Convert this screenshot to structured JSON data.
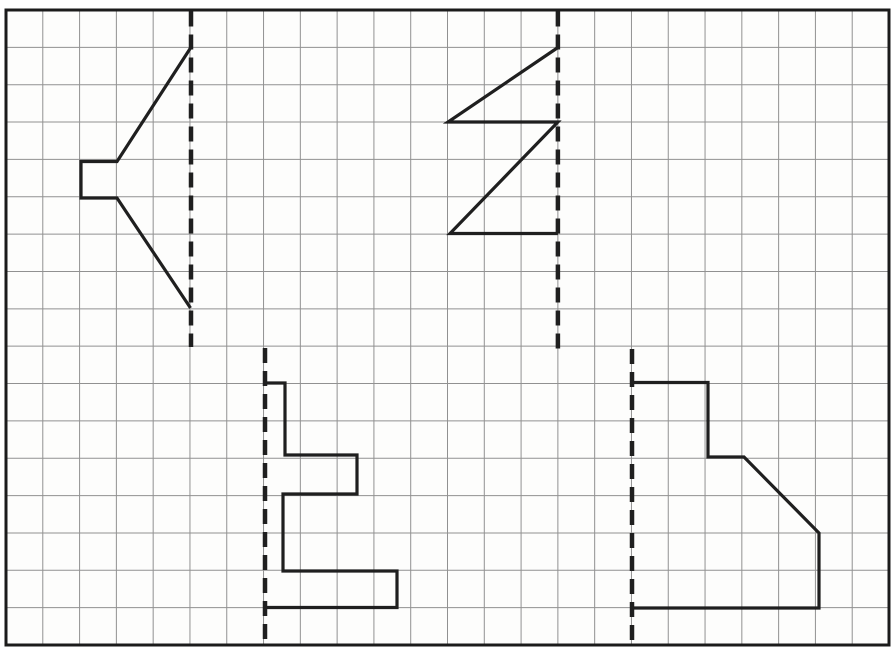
{
  "worksheet": {
    "kind": "reflection-symmetry-grid-exercise",
    "canvas": {
      "width": 895,
      "height": 656
    },
    "colors": {
      "paper": "#fdfdfc",
      "grid_line": "#919191",
      "border": "#1b1b1b",
      "ink": "#1f1f1f"
    },
    "grid": {
      "columns": 24,
      "rows": 17,
      "x0": 6,
      "y0": 10,
      "x1": 889,
      "y1": 645,
      "grid_line_width": 1,
      "border_width": 3
    },
    "mirror_style": {
      "width": 4.5,
      "dash": "15 8"
    },
    "shape_style": {
      "width": 3.2
    },
    "mirror_lines": [
      {
        "id": "mirror-line-speaker",
        "x": 191,
        "y1": 11.5,
        "y2": 347
      },
      {
        "id": "mirror-line-zigzag",
        "x": 557.9,
        "y1": 11.5,
        "y2": 356
      },
      {
        "id": "mirror-line-staircase",
        "x": 265,
        "y1": 348,
        "y2": 643
      },
      {
        "id": "mirror-line-block",
        "x": 632,
        "y1": 349,
        "y2": 642
      }
    ],
    "half_shapes": [
      {
        "id": "speaker-shape-half",
        "points": [
          [
            190.5,
            48
          ],
          [
            117,
            161.5
          ],
          [
            81,
            161.5
          ],
          [
            81,
            198
          ],
          [
            117,
            198
          ],
          [
            190.5,
            308
          ]
        ]
      },
      {
        "id": "zigzag-shape-half",
        "points": [
          [
            557.9,
            47.5
          ],
          [
            448,
            122
          ],
          [
            557.9,
            122
          ],
          [
            450,
            233.5
          ],
          [
            557.9,
            233.5
          ]
        ]
      },
      {
        "id": "staircase-shape-half",
        "points": [
          [
            265,
            383
          ],
          [
            285,
            383
          ],
          [
            285,
            455
          ],
          [
            357,
            455
          ],
          [
            357,
            494
          ],
          [
            283,
            494
          ],
          [
            283,
            571
          ],
          [
            397,
            571
          ],
          [
            397,
            607.5
          ],
          [
            265,
            607.5
          ]
        ]
      },
      {
        "id": "block-corner-shape-half",
        "points": [
          [
            632,
            382.5
          ],
          [
            708,
            382.5
          ],
          [
            708,
            457
          ],
          [
            744,
            457
          ],
          [
            819,
            533
          ],
          [
            819,
            608
          ],
          [
            632,
            608
          ]
        ]
      }
    ]
  }
}
